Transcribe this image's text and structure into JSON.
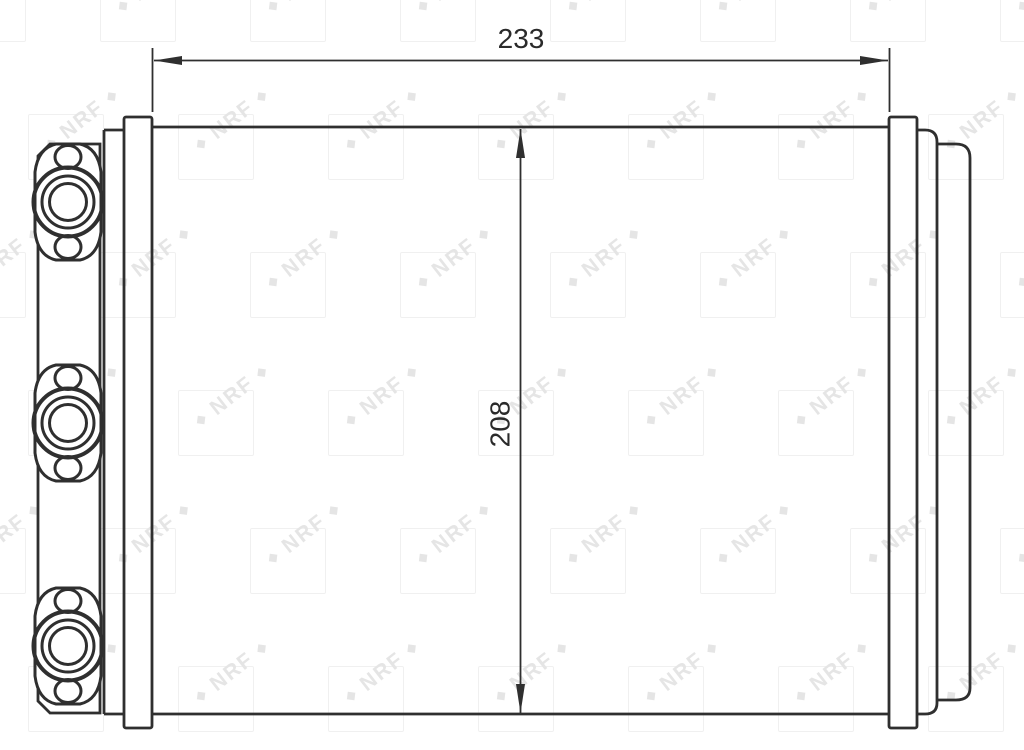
{
  "drawing": {
    "type": "technical-part-drawing",
    "subject": "heater-core-with-three-port-flanges",
    "watermark": {
      "text": "NRF",
      "diamond_glyph": "◆"
    },
    "dimensions": {
      "width": {
        "value": "233",
        "orientation": "horizontal"
      },
      "height": {
        "value": "208",
        "orientation": "vertical"
      }
    },
    "fittings_count": "3",
    "colors": {
      "line": "#2f2f2f",
      "dim_text": "#2a2a2a",
      "watermark": "#e5e5e5",
      "background": "#ffffff"
    }
  }
}
